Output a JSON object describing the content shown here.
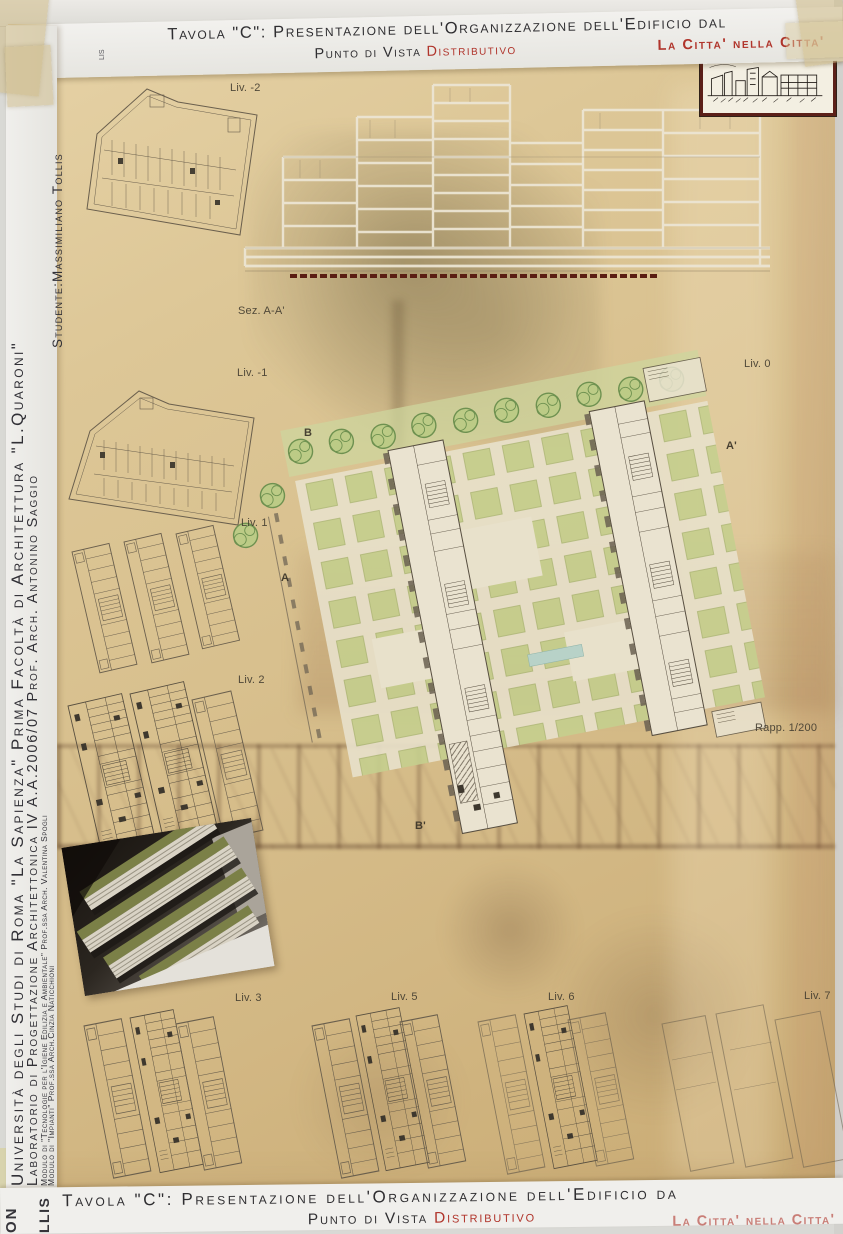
{
  "header": {
    "title": "Tavola \"C\": Presentazione dell'Organizzazione dell'Edificio dal",
    "subtitle_prefix": "Punto di Vista ",
    "subtitle_accent": "Distributivo",
    "motto": "La Citta' nella Citta'",
    "stray_fragment": "lis"
  },
  "sidebar": {
    "university": "Università degli Studi di Roma \"La Sapienza\" Prima Facoltà di Architettura \"L.Quaroni\"",
    "laboratory": "Laboratorio di Progettazione Architettonica IV A.A.2006/07 Prof. Arch. Antonino Saggio",
    "module1": "Modulo di \"Tecnologie per l'Igiene Edilizia e Ambientale\" Prof.ssa Arch. Valentina Spogli",
    "module2": "Modulo di \"Impianti\" Prof.ssa Arch.Cinzia Naticchioni",
    "student": "Studente:Massimiliano Tollis"
  },
  "plan_labels": {
    "liv_m2": "Liv. -2",
    "section": "Sez. A-A'",
    "liv_m1": "Liv. -1",
    "liv_0": "Liv. 0",
    "liv_1": "Liv. 1",
    "liv_2": "Liv. 2",
    "liv_3": "Liv. 3",
    "liv_5": "Liv. 5",
    "liv_6": "Liv. 6",
    "liv_7": "Liv. 7",
    "scale": "Rapp. 1/200"
  },
  "markers": {
    "a": "A",
    "a_prime": "A'",
    "b": "B",
    "b_prime": "B'"
  },
  "bottom_strip": {
    "title": "Tavola \"C\": Presentazione dell'Organizzazione dell'Edificio da",
    "subtitle_prefix": "Punto di Vista ",
    "subtitle_accent": "Distributivo",
    "motto": "La Citta' nella Citta'",
    "fragment_oni": "ON",
    "fragment_llis": "LLIS"
  },
  "colors": {
    "board_tan": "#d8c192",
    "strip_white": "#efefec",
    "text_dark": "#2f2e31",
    "accent_red": "#b0342b",
    "drawing_line": "#6a5f4d",
    "lawn_green": "#c5cf8e",
    "tree_green": "#6e9150",
    "section_white": "#ece5d3",
    "section_base_red": "#5a1d13"
  }
}
